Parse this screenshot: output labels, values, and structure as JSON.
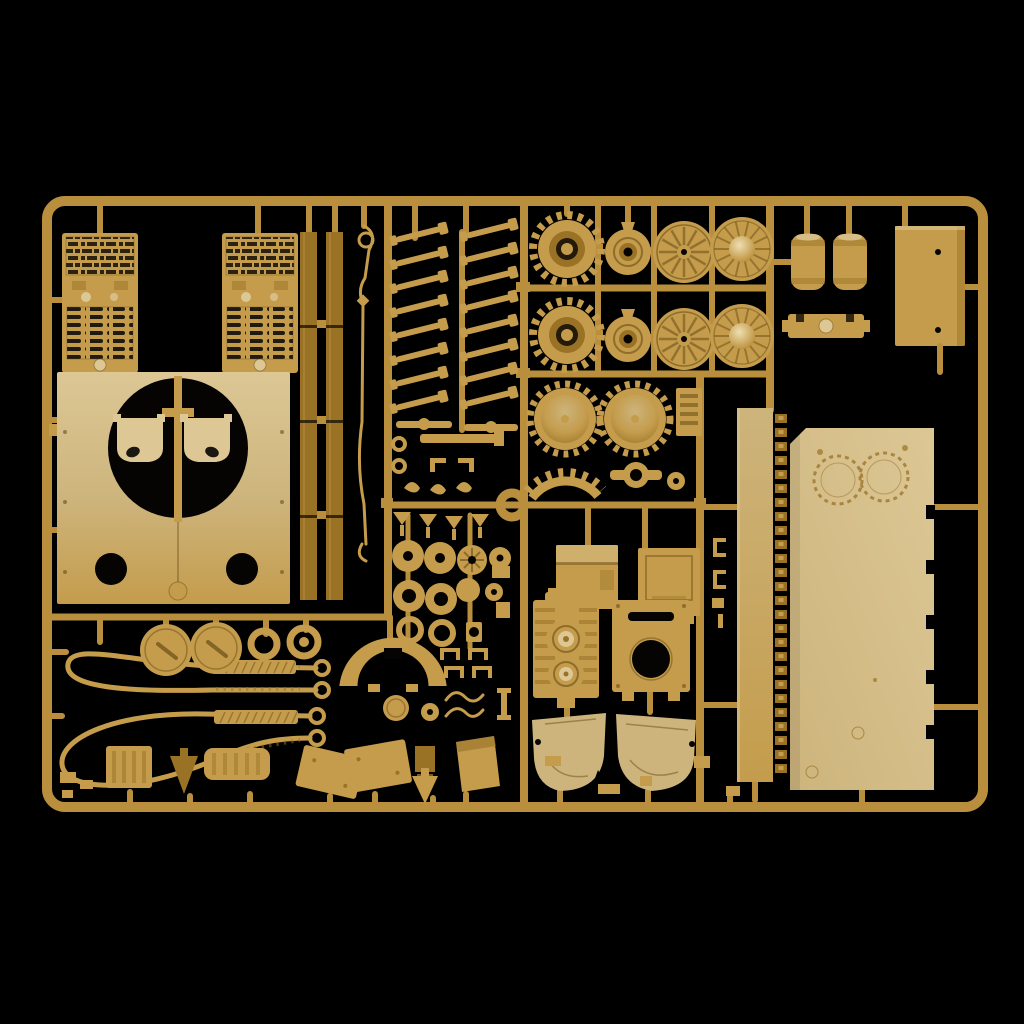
{
  "scene": {
    "description": "Studio photograph of a tan injection-moulded plastic model kit sprue (1/35 tank parts tree) laid on a black background",
    "background": "#000000"
  },
  "colors": {
    "runner": "#b98f3e",
    "plastic": "#c49c4c",
    "plastic_light": "#dcc795",
    "plastic_pale": "#cdb47c",
    "plastic_dark": "#9a7226",
    "plastic_deep": "#6b4f16",
    "highlight": "#eedfb2",
    "hole": "#050403",
    "bg": "#000000"
  },
  "parts": {
    "sprue_frame": "rectangular runner frame with rounded corners and internal runner rails",
    "engine_grilles": "2 engine-deck grille panels with mesh and louvre vents",
    "hull_top_panel": "hull roof panel with large circular turret-ring opening, two hatch holes and two mount brackets",
    "side_skirts": "2 long segmented side-skirt strips",
    "tow_hook_rod": "thin wire tow-hook / cleaning rod",
    "torsion_bars": "16 angled torsion-bar swing arms in two columns",
    "drive_sprockets": "2 toothed drive sprocket wheels",
    "sprocket_dishes": "2 dished sprocket halves with rim teeth",
    "idler_hubs": "2 cone hub caps",
    "road_wheels": "4 spoked road wheels (2 domed)",
    "mufflers": "2 cylindrical exhaust mufflers",
    "exhaust_bracket": "exhaust mounting bracket",
    "stowage_box": "large rectangular stowage box with rivets",
    "track_guard_strip": "tall strip with moulded track-teeth edge",
    "lower_hull_panel": "large hull side panel with notched edge and round access rings",
    "fuel_tanks": "2 stowage / fuel tank boxes",
    "engine_block": "engine block with twin cooling fans",
    "rear_plate": "rear hull plate with vision slot and circular opening",
    "hull_side_panels": "2 curved lower hull side panels",
    "tow_cables": "2 looped braided tow cables with eyelet ends and woven sleeves",
    "round_hatches": "2 round hatch lids with handles and 2 ring collars",
    "fan_shroud_arc": "curved fan-shroud arc segment",
    "small_fittings": "assorted washers, funnels, hubs, clamps, grab handles, crates and fender pieces"
  }
}
